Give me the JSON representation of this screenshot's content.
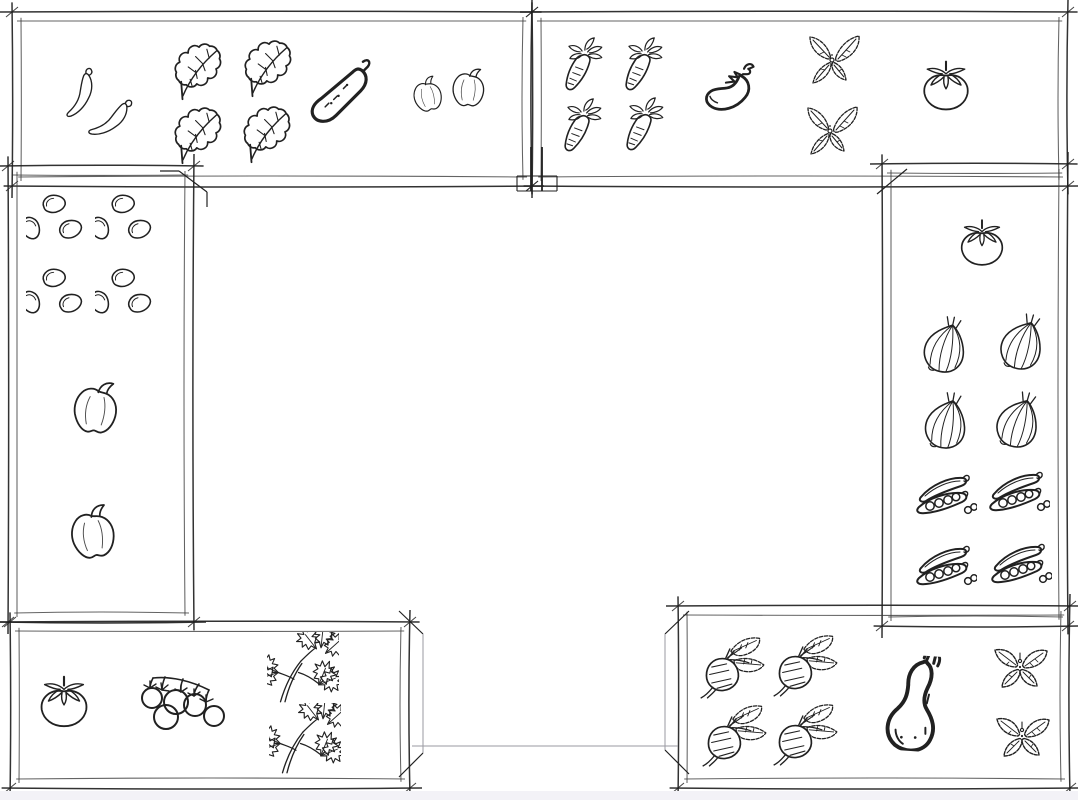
{
  "canvas": {
    "width": 1078,
    "height": 800,
    "background": "#ffffff",
    "ink": "#212121",
    "inner_line": "#3c3c3c",
    "faint_line": "#9a9aa2",
    "footer_strip": "#f3f2f7"
  },
  "plant_key": {
    "chili": "chili-pepper-icon",
    "kale": "kale-leaf-icon",
    "cucumber": "cucumber-icon",
    "pepper": "bell-pepper-icon",
    "carrot": "carrot-icon",
    "eggplant": "eggplant-icon",
    "mint": "mint-sprig-icon",
    "tomato": "tomato-icon",
    "beans": "bean-cluster-icon",
    "onion": "onion-icon",
    "peas": "pea-pod-icon",
    "cherry-tomatoes": "cherry-tomato-cluster-icon",
    "parsley": "parsley-icon",
    "radish": "radish-icon",
    "butternut": "butternut-squash-icon",
    "basil": "basil-icon"
  },
  "beds": [
    {
      "id": "top-left",
      "x": 12,
      "y": 12,
      "w": 520,
      "h": 174,
      "plants": [
        {
          "type": "chili",
          "x": 82,
          "y": 92,
          "s": 54,
          "r": -6
        },
        {
          "type": "chili",
          "x": 113,
          "y": 118,
          "s": 54,
          "r": 22
        },
        {
          "type": "kale",
          "x": 196,
          "y": 67,
          "s": 78,
          "r": -38
        },
        {
          "type": "kale",
          "x": 266,
          "y": 64,
          "s": 78,
          "r": -38
        },
        {
          "type": "kale",
          "x": 196,
          "y": 131,
          "s": 78,
          "r": -38
        },
        {
          "type": "kale",
          "x": 265,
          "y": 130,
          "s": 78,
          "r": -38
        },
        {
          "type": "cucumber",
          "x": 341,
          "y": 91,
          "s": 78,
          "r": 0
        },
        {
          "type": "pepper",
          "x": 427,
          "y": 95,
          "s": 44,
          "r": -12
        },
        {
          "type": "pepper",
          "x": 468,
          "y": 88,
          "s": 50,
          "r": 5
        }
      ]
    },
    {
      "id": "top-right",
      "x": 532,
      "y": 12,
      "w": 536,
      "h": 174,
      "plants": [
        {
          "type": "carrot",
          "x": 583,
          "y": 66,
          "s": 60,
          "r": 0
        },
        {
          "type": "carrot",
          "x": 643,
          "y": 66,
          "s": 60,
          "r": 0
        },
        {
          "type": "carrot",
          "x": 582,
          "y": 127,
          "s": 60,
          "r": 0
        },
        {
          "type": "carrot",
          "x": 644,
          "y": 126,
          "s": 60,
          "r": 0
        },
        {
          "type": "eggplant",
          "x": 727,
          "y": 89,
          "s": 68,
          "r": 0
        },
        {
          "type": "mint",
          "x": 832,
          "y": 62,
          "s": 64,
          "r": 0
        },
        {
          "type": "mint",
          "x": 830,
          "y": 133,
          "s": 64,
          "r": 0
        },
        {
          "type": "tomato",
          "x": 946,
          "y": 86,
          "s": 60,
          "r": 0
        }
      ]
    },
    {
      "id": "left",
      "x": 8,
      "y": 166,
      "w": 186,
      "h": 456,
      "plants": [
        {
          "type": "beans",
          "x": 57,
          "y": 224,
          "s": 62,
          "r": 0
        },
        {
          "type": "beans",
          "x": 126,
          "y": 224,
          "s": 62,
          "r": 0
        },
        {
          "type": "beans",
          "x": 57,
          "y": 298,
          "s": 62,
          "r": 0
        },
        {
          "type": "beans",
          "x": 126,
          "y": 298,
          "s": 62,
          "r": 0
        },
        {
          "type": "pepper",
          "x": 95,
          "y": 408,
          "s": 68,
          "r": 8
        },
        {
          "type": "pepper",
          "x": 92,
          "y": 533,
          "s": 68,
          "r": -6
        }
      ]
    },
    {
      "id": "right",
      "x": 882,
      "y": 164,
      "w": 186,
      "h": 462,
      "plants": [
        {
          "type": "tomato",
          "x": 982,
          "y": 243,
          "s": 56,
          "r": 0
        },
        {
          "type": "onion",
          "x": 945,
          "y": 347,
          "s": 64,
          "r": 12
        },
        {
          "type": "onion",
          "x": 1022,
          "y": 344,
          "s": 64,
          "r": 16
        },
        {
          "type": "onion",
          "x": 946,
          "y": 423,
          "s": 64,
          "r": 10
        },
        {
          "type": "onion",
          "x": 1018,
          "y": 422,
          "s": 64,
          "r": 16
        },
        {
          "type": "peas",
          "x": 945,
          "y": 501,
          "s": 64,
          "r": 0
        },
        {
          "type": "peas",
          "x": 1018,
          "y": 498,
          "s": 64,
          "r": 0
        },
        {
          "type": "peas",
          "x": 945,
          "y": 572,
          "s": 64,
          "r": 0
        },
        {
          "type": "peas",
          "x": 1020,
          "y": 570,
          "s": 64,
          "r": 0
        }
      ]
    },
    {
      "id": "bottom-left",
      "x": 10,
      "y": 622,
      "w": 400,
      "h": 166,
      "plants": [
        {
          "type": "tomato",
          "x": 64,
          "y": 702,
          "s": 62,
          "r": 0
        },
        {
          "type": "cherry-tomatoes",
          "x": 183,
          "y": 703,
          "s": 64,
          "r": 0
        },
        {
          "type": "parsley",
          "x": 303,
          "y": 668,
          "s": 72,
          "r": 0
        },
        {
          "type": "parsley",
          "x": 305,
          "y": 739,
          "s": 72,
          "r": 0
        }
      ]
    },
    {
      "id": "bottom-right",
      "x": 678,
      "y": 606,
      "w": 392,
      "h": 182,
      "plants": [
        {
          "type": "radish",
          "x": 733,
          "y": 666,
          "s": 68,
          "r": 0
        },
        {
          "type": "radish",
          "x": 806,
          "y": 664,
          "s": 68,
          "r": 0
        },
        {
          "type": "radish",
          "x": 735,
          "y": 734,
          "s": 68,
          "r": 0
        },
        {
          "type": "radish",
          "x": 806,
          "y": 733,
          "s": 68,
          "r": 0
        },
        {
          "type": "butternut",
          "x": 913,
          "y": 703,
          "s": 96,
          "r": 4
        },
        {
          "type": "basil",
          "x": 1020,
          "y": 671,
          "s": 64,
          "r": 0
        },
        {
          "type": "basil",
          "x": 1022,
          "y": 740,
          "s": 64,
          "r": 0
        }
      ]
    }
  ],
  "frame_accents": [
    {
      "x1": 531,
      "y1": 147,
      "x2": 531,
      "y2": 191,
      "w": 1.8
    },
    {
      "x1": 542,
      "y1": 147,
      "x2": 542,
      "y2": 191,
      "w": 1.8
    },
    {
      "x1": 517,
      "y1": 176,
      "x2": 557,
      "y2": 176,
      "w": 1.1
    },
    {
      "x1": 517,
      "y1": 191,
      "x2": 557,
      "y2": 191,
      "w": 1.1
    },
    {
      "x1": 517,
      "y1": 176,
      "x2": 517,
      "y2": 191,
      "w": 1.1
    },
    {
      "x1": 557,
      "y1": 176,
      "x2": 557,
      "y2": 191,
      "w": 1.1
    },
    {
      "x1": 160,
      "y1": 171,
      "x2": 179,
      "y2": 171,
      "w": 1.2
    },
    {
      "x1": 179,
      "y1": 171,
      "x2": 207,
      "y2": 192,
      "w": 1.2
    },
    {
      "x1": 207,
      "y1": 192,
      "x2": 207,
      "y2": 207,
      "w": 1.2
    },
    {
      "x1": 907,
      "y1": 169,
      "x2": 877,
      "y2": 194,
      "w": 1.2
    },
    {
      "x1": 399,
      "y1": 611,
      "x2": 423,
      "y2": 634,
      "w": 1.2
    },
    {
      "x1": 423,
      "y1": 634,
      "x2": 423,
      "y2": 753,
      "w": 1,
      "light": true
    },
    {
      "x1": 399,
      "y1": 777,
      "x2": 423,
      "y2": 753,
      "w": 1.2
    },
    {
      "x1": 689,
      "y1": 611,
      "x2": 665,
      "y2": 634,
      "w": 1.2
    },
    {
      "x1": 665,
      "y1": 634,
      "x2": 665,
      "y2": 750,
      "w": 1,
      "light": true
    },
    {
      "x1": 689,
      "y1": 774,
      "x2": 665,
      "y2": 750,
      "w": 1.2
    },
    {
      "x1": 412,
      "y1": 746,
      "x2": 678,
      "y2": 746,
      "w": 1,
      "light": true
    }
  ]
}
